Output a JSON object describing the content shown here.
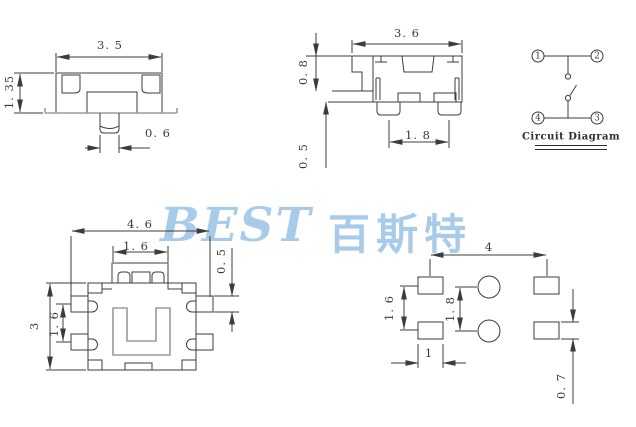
{
  "watermark": {
    "latin": "BEST",
    "cjk": "百斯特",
    "color": "#a5c9e9"
  },
  "line_color": "#3c3c3c",
  "front": {
    "width": "3. 5",
    "height": "1. 35",
    "stem_width": "0. 6"
  },
  "side": {
    "width": "3. 6",
    "stem_height": "0. 8",
    "standoff": "0. 5",
    "terminal_pitch": "1. 8"
  },
  "circuit": {
    "title": "Circuit Diagram",
    "terminals": [
      "1",
      "2",
      "3",
      "4"
    ]
  },
  "top": {
    "width": "4. 6",
    "stem_width": "1. 6",
    "terminal_thickness": "0. 5",
    "height": "3",
    "terminal_pitch": "1. 6"
  },
  "pcb": {
    "pad_span": "4",
    "pad_pitch": "1. 6",
    "hole_pitch": "1. 8",
    "pad_width": "1",
    "pad_height": "0. 7"
  }
}
